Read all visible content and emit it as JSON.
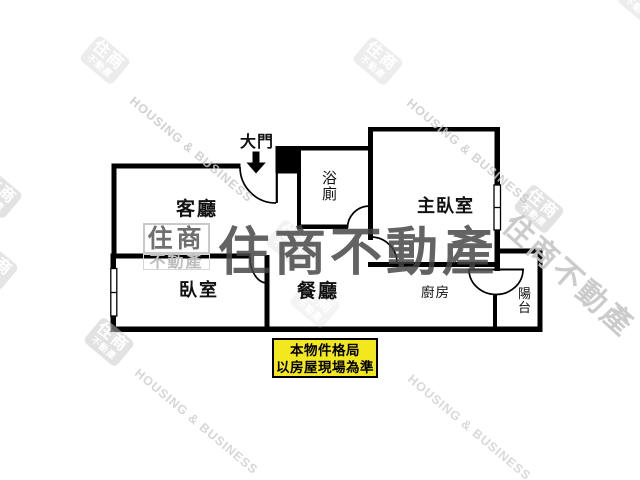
{
  "page": {
    "type": "real-estate floor plan",
    "background": "#ffffff"
  },
  "floor_plan": {
    "entrance": {
      "label": "大門",
      "arrow_icon": "down-arrow"
    },
    "rooms": {
      "living_room": "客廳",
      "bedroom": "臥室",
      "master_bedroom": "主臥室",
      "dining_room": "餐廳",
      "kitchen": "廚房",
      "bathroom": "浴廁",
      "balcony": "陽台"
    }
  },
  "disclaimer": {
    "line1": "本物件格局",
    "line2": "以房屋現場為準",
    "background": "#f3e71e",
    "border_color": "#000000"
  },
  "watermark": {
    "brand_full": "住商不動產",
    "logo_main": "住商",
    "logo_sub": "不動產",
    "brand_en": "HOUSING & BUSINESS"
  },
  "colors": {
    "wall": "#000000",
    "watermark_gray": "#c8c8c8",
    "watermark_dark": "#464646"
  }
}
